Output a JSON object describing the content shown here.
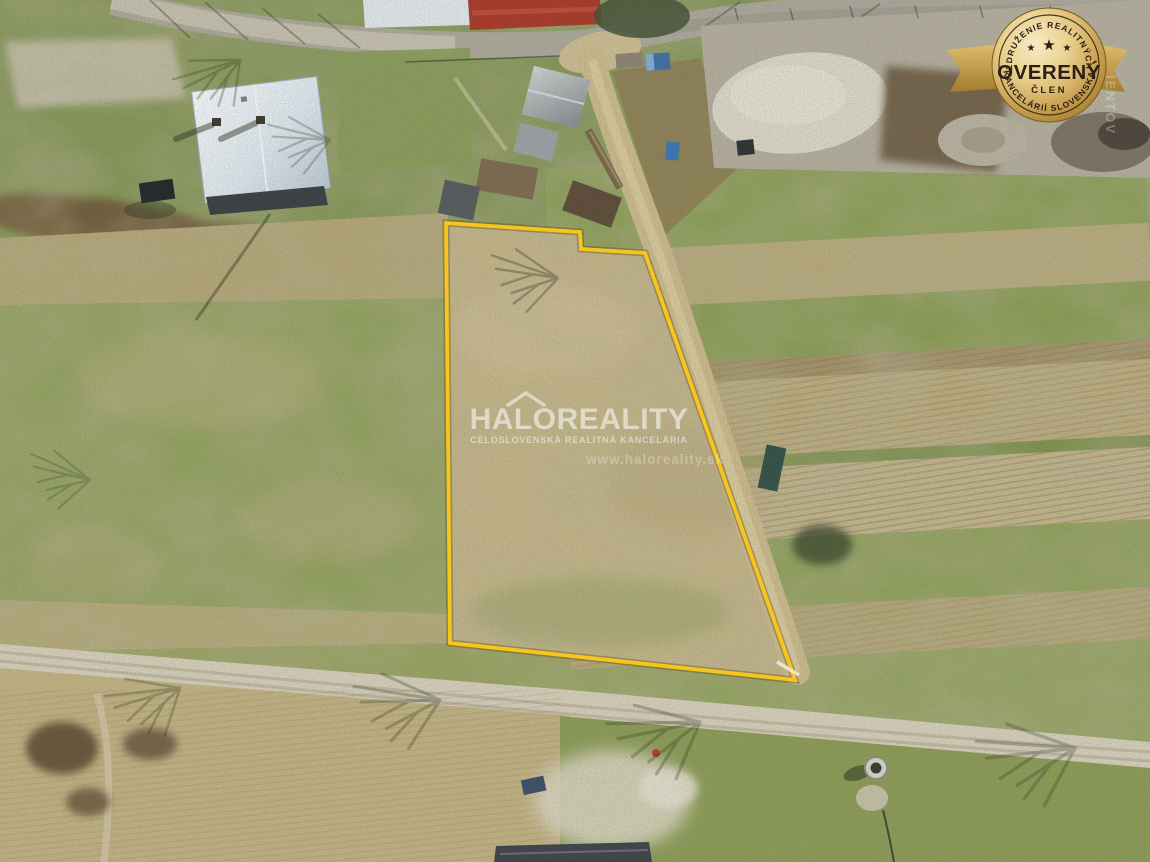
{
  "watermark": {
    "icon": "house-roof-icon",
    "brand": "HALOREALITY",
    "tagline": "CELOSLOVENSKÁ REALITNÁ KANCELÁRIA",
    "website": "www.haloreality.sk",
    "color": "#FFFFFF"
  },
  "badge": {
    "arc_top": "ZDRUŽENIE REALITNÝCH",
    "title": "OVERENÝ",
    "subtitle": "ČLEN",
    "arc_bottom": "KANCELÁRIÍ SLOVENSKA",
    "star_glyph": "★",
    "colors": {
      "gold_light": "#F8ECC0",
      "gold_mid": "#DCBA6B",
      "gold_dark": "#9C7527",
      "text": "#2B2013"
    }
  },
  "side_watermark": "IENTOV",
  "parcel": {
    "outline_points": "446,223 580,232 581,249 645,253 795,680 450,643",
    "outline_color": "#F6C61A"
  }
}
